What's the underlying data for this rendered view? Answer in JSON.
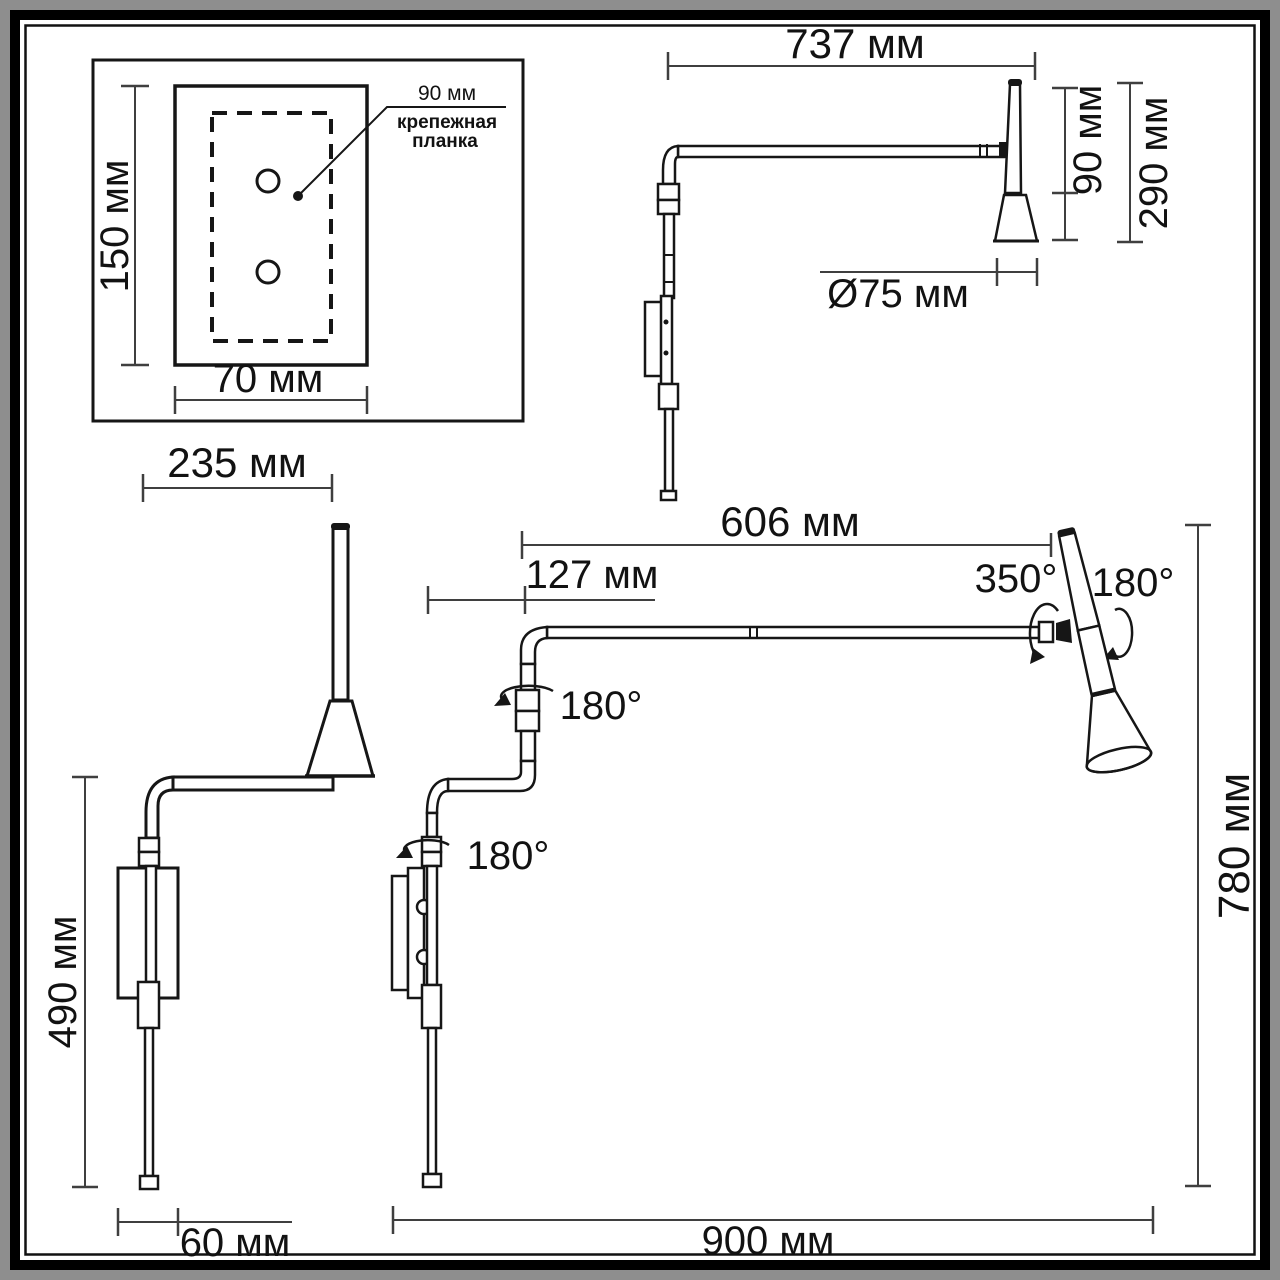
{
  "drawing": {
    "title_hint": "wall lamp dimensional drawing",
    "inset": {
      "height_label": "150 мм",
      "width_label": "70 мм",
      "strip_width_label": "90 мм",
      "strip_caption1": "крепежная",
      "strip_caption2": "планка"
    },
    "side_view": {
      "arm_label": "737 мм",
      "shade_label": "90 мм",
      "head_label": "290 мм",
      "diameter_label": "Ø75 мм"
    },
    "folded_view": {
      "arm_label": "235 мм",
      "height_label": "490 мм",
      "base_label": "60 мм"
    },
    "extended_view": {
      "arm_label": "606 мм",
      "offset_label": "127 мм",
      "head_rotation_label": "350°",
      "head_tilt_label": "180°",
      "mid_swivel_label": "180°",
      "base_swivel_label": "180°",
      "height_label": "780 мм",
      "reach_label": "900 мм"
    },
    "colors": {
      "ink": "#161616",
      "dimension_lines": "#3f3f3f",
      "paper": "#ffffff",
      "frame": "#000000",
      "margin": "#8e8e8e"
    }
  }
}
